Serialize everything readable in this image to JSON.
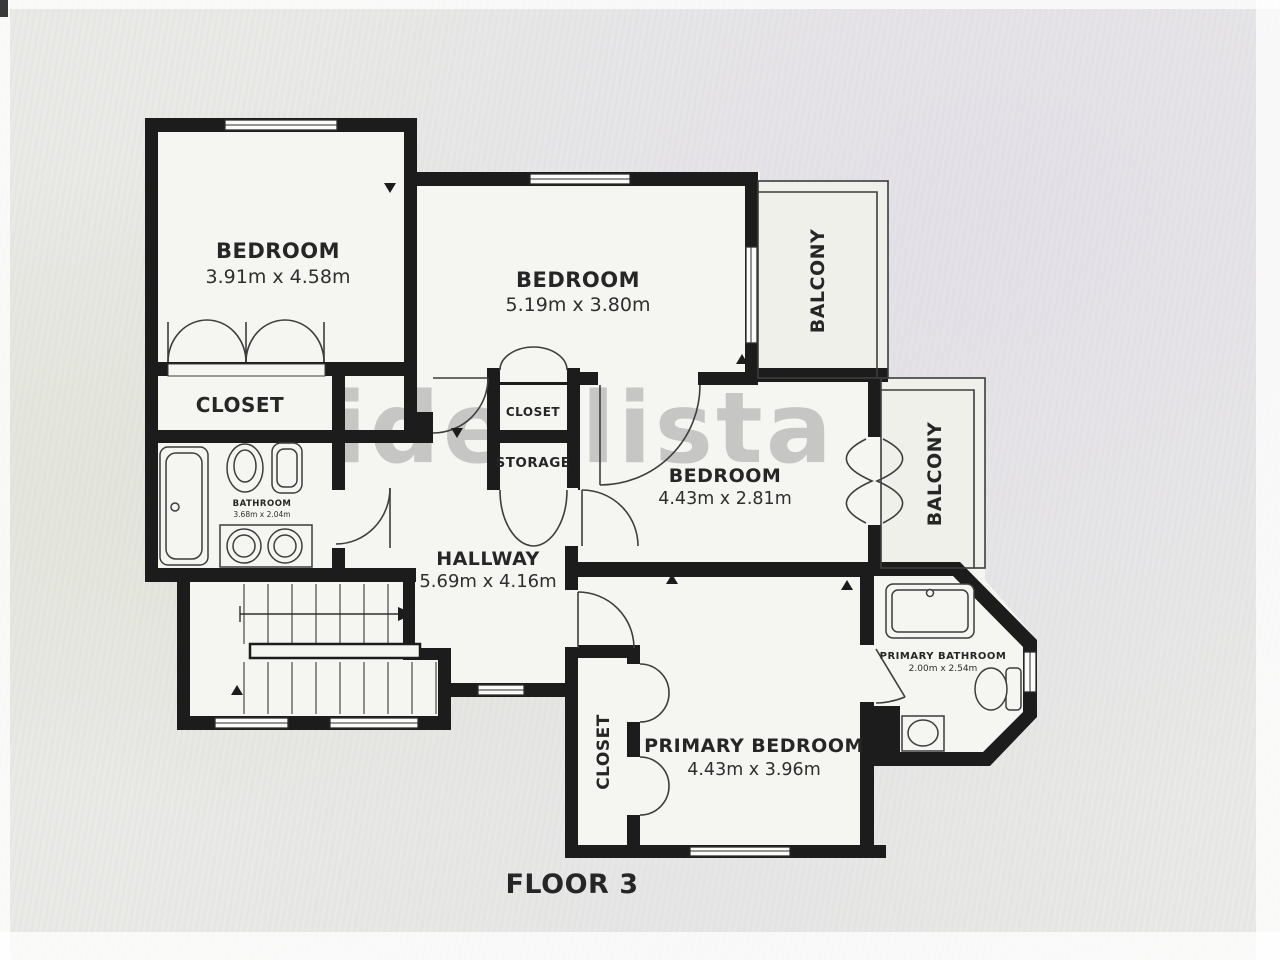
{
  "title": "Floor plan",
  "floor_label": "FLOOR 3",
  "watermark": "idealista",
  "rooms": {
    "bedroom1": {
      "label": "BEDROOM",
      "dims": "3.91m x 4.58m"
    },
    "bedroom2": {
      "label": "BEDROOM",
      "dims": "5.19m x 3.80m"
    },
    "bedroom3": {
      "label": "BEDROOM",
      "dims": "4.43m x 2.81m"
    },
    "primary_bedroom": {
      "label": "PRIMARY BEDROOM",
      "dims": "4.43m x 3.96m"
    },
    "hallway": {
      "label": "HALLWAY",
      "dims": "5.69m x 4.16m"
    },
    "bathroom": {
      "label": "BATHROOM",
      "dims": "3.68m x 2.04m"
    },
    "primary_bathroom": {
      "label": "PRIMARY BATHROOM",
      "dims": "2.00m x 2.54m"
    },
    "closet_main": {
      "label": "CLOSET"
    },
    "closet_small": {
      "label": "CLOSET"
    },
    "storage": {
      "label": "STORAGE"
    },
    "closet_primary": {
      "label": "CLOSET"
    },
    "balcony_top": {
      "label": "BALCONY"
    },
    "balcony_right": {
      "label": "BALCONY"
    }
  },
  "colors": {
    "wall": "#1c1c1c",
    "floor": "#f5f5f1",
    "background": "#e9e9e6",
    "watermark": "#8f8f8f"
  }
}
